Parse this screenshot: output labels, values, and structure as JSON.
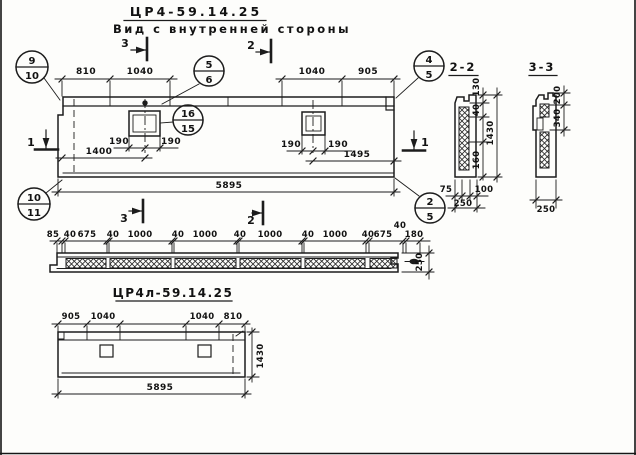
{
  "title": {
    "code": "ЦР4-59.14.25",
    "view_label": "Вид с внутренней стороны"
  },
  "main_view": {
    "dims_top_left": [
      "810",
      "1040"
    ],
    "dims_top_right": [
      "1040",
      "905"
    ],
    "sq1_dims": [
      "190",
      "190"
    ],
    "sq2_dims": [
      "190",
      "190"
    ],
    "dim_to_sq1": "1400",
    "dim_to_sq2": "1495",
    "dim_overall": "5895",
    "marks": {
      "top_left": "3",
      "top_right": "2",
      "bottom_left": "3",
      "bottom_right": "2",
      "side_left": "1",
      "side_right": "1"
    },
    "callouts": {
      "top_left": {
        "num": "9",
        "den": "10"
      },
      "top_mid": {
        "num": "5",
        "den": "6"
      },
      "top_right": {
        "num": "4",
        "den": "5"
      },
      "bottom_left": {
        "num": "10",
        "den": "11"
      },
      "opening": {
        "num": "16",
        "den": "15"
      },
      "bottom_right": {
        "num": "2",
        "den": "5"
      }
    }
  },
  "plan_view": {
    "dims": [
      "85",
      "40",
      "675",
      "40",
      "1000",
      "40",
      "1000",
      "40",
      "1000",
      "40",
      "1000",
      "40",
      "675",
      "40",
      "180"
    ],
    "height_dim": "250"
  },
  "section_2_2": {
    "title": "2-2",
    "dim_130": "130",
    "dim_40": "40",
    "dim_1430": "1430",
    "dim_160": "160",
    "dim_75": "75",
    "dim_100": "100",
    "dim_250": "250"
  },
  "section_3_3": {
    "title": "3-3",
    "dim_200": "200",
    "dim_340": "340",
    "dim_250": "250"
  },
  "bottom_view": {
    "code": "ЦР4л-59.14.25",
    "dims_left": [
      "905",
      "1040"
    ],
    "dims_right": [
      "1040",
      "810"
    ],
    "dim_height": "1430",
    "dim_overall": "5895"
  }
}
